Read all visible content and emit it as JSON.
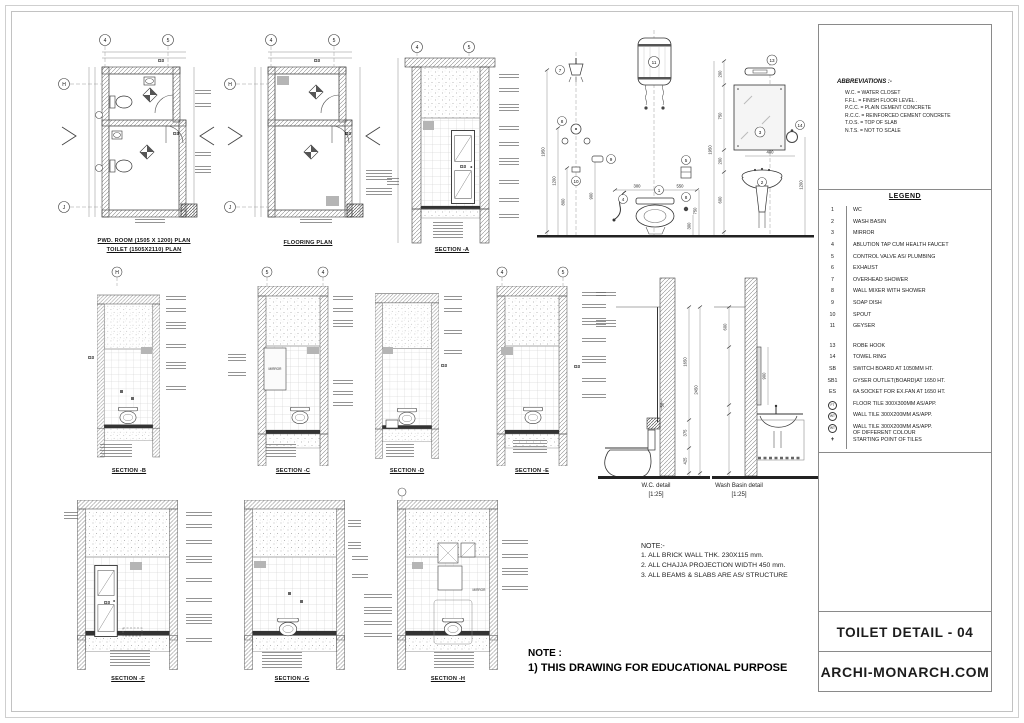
{
  "sheet": {
    "title": "TOILET DETAIL - 04",
    "website": "ARCHI-MONARCH.COM"
  },
  "abbreviations": {
    "heading": "ABBREVIATIONS :-",
    "items": [
      "W.C.  =  WATER CLOSET",
      "F.F.L.  =  FINISH FLOOR  LEVEL .",
      "P.C.C. = PLAIN CEMENT CONCRETE",
      "R.C.C. = REINFORCED CEMENT CONCRETE",
      "T.O.S.  = TOP OF SLAB",
      "N.T.S.  = NOT TO  SCALE"
    ]
  },
  "legend": {
    "heading": "LEGEND",
    "items": [
      {
        "key": "1",
        "label": "WC"
      },
      {
        "key": "2",
        "label": "WASH BASIN"
      },
      {
        "key": "3",
        "label": "MIRROR"
      },
      {
        "key": "4",
        "label": "ABLUTION TAP CUM HEALTH FAUCET"
      },
      {
        "key": "5",
        "label": "CONTROL VALVE AS/ PLUMBING"
      },
      {
        "key": "6",
        "label": "EXHAUST"
      },
      {
        "key": "7",
        "label": "OVERHEAD SHOWER"
      },
      {
        "key": "8",
        "label": "WALL MIXER WITH SHOWER"
      },
      {
        "key": "9",
        "label": "SOAP DISH"
      },
      {
        "key": "10",
        "label": "SPOUT"
      },
      {
        "key": "11",
        "label": "GEYSER"
      },
      {
        "key": "13",
        "label": "ROBE HOOK"
      },
      {
        "key": "14",
        "label": "TOWEL RING"
      },
      {
        "key": "SB",
        "label": "SWITCH BOARD AT 1050MM HT."
      },
      {
        "key": "SB1",
        "label": "GYSER OUTLET(BOARD)AT 1650 HT."
      },
      {
        "key": "ES",
        "label": "6A SOCKET FOR EX.FAN AT 1650 HT."
      },
      {
        "key": "FT",
        "label": "FLOOR TILE 300X300MM AS/APP."
      },
      {
        "key": "WT",
        "label": "WALL TILE 300X200MM AS/APP."
      },
      {
        "key": "WT",
        "label": "WALL TILE 300X200MM AS/APP.",
        "label2": "OF DIFFERENT COLOUR"
      },
      {
        "key": "+",
        "label": "STARTING POINT OF TILES"
      }
    ]
  },
  "captions": {
    "plan1_line1": "PWD. ROOM (1505 X 1200) PLAN",
    "plan1_line2": "TOILET  (1505X2110) PLAN",
    "plan2": "FLOORING PLAN",
    "section_a": "SECTION -A",
    "section_b": "SECTION -B",
    "section_c": "SECTION -C",
    "section_d": "SECTION -D",
    "section_e": "SECTION -E",
    "section_f": "SECTION -F",
    "section_g": "SECTION -G",
    "section_h": "SECTION -H",
    "wc_detail": "W.C. detail",
    "wc_detail_scale": "[1:25]",
    "basin_detail": "Wash Basin detail",
    "basin_detail_scale": "[1:25]"
  },
  "notes": {
    "heading": "NOTE:-",
    "items": [
      "1. ALL BRICK WALL THK. 230X115 mm.",
      "2. ALL CHAJJA PROJECTION WIDTH 450 mm.",
      "3. ALL BEAMS & SLABS ARE AS/ STRUCTURE"
    ]
  },
  "footer_note": {
    "heading": "NOTE :",
    "line1": "1) THIS DRAWING FOR EDUCATIONAL PURPOSE"
  },
  "grid": {
    "b4": "4",
    "b5": "5",
    "bH": "H",
    "bJ": "J"
  },
  "door_tag": "D3",
  "labels": {
    "mirror": "MIRROR"
  },
  "elevation": {
    "dims": {
      "d1950": "1950",
      "d1200": "1200",
      "d800": "800",
      "d900": "900",
      "d300": "300",
      "d550": "550",
      "d750": "750",
      "d200": "200",
      "d400": "400",
      "d600": "600"
    },
    "tags": {
      "t1": "1",
      "t2": "2",
      "t3": "3",
      "t4": "4",
      "t5": "5",
      "t7": "7",
      "t8": "8",
      "t9": "9",
      "t10": "10",
      "t11": "11",
      "t13": "13",
      "t14": "14"
    }
  },
  "wc_detail": {
    "dims": {
      "d50": "50",
      "d1650": "1650",
      "d2450": "2450",
      "d375": "375",
      "d425": "425"
    }
  },
  "basin_detail": {
    "dims": {
      "d600": "600",
      "d900": "900"
    }
  }
}
